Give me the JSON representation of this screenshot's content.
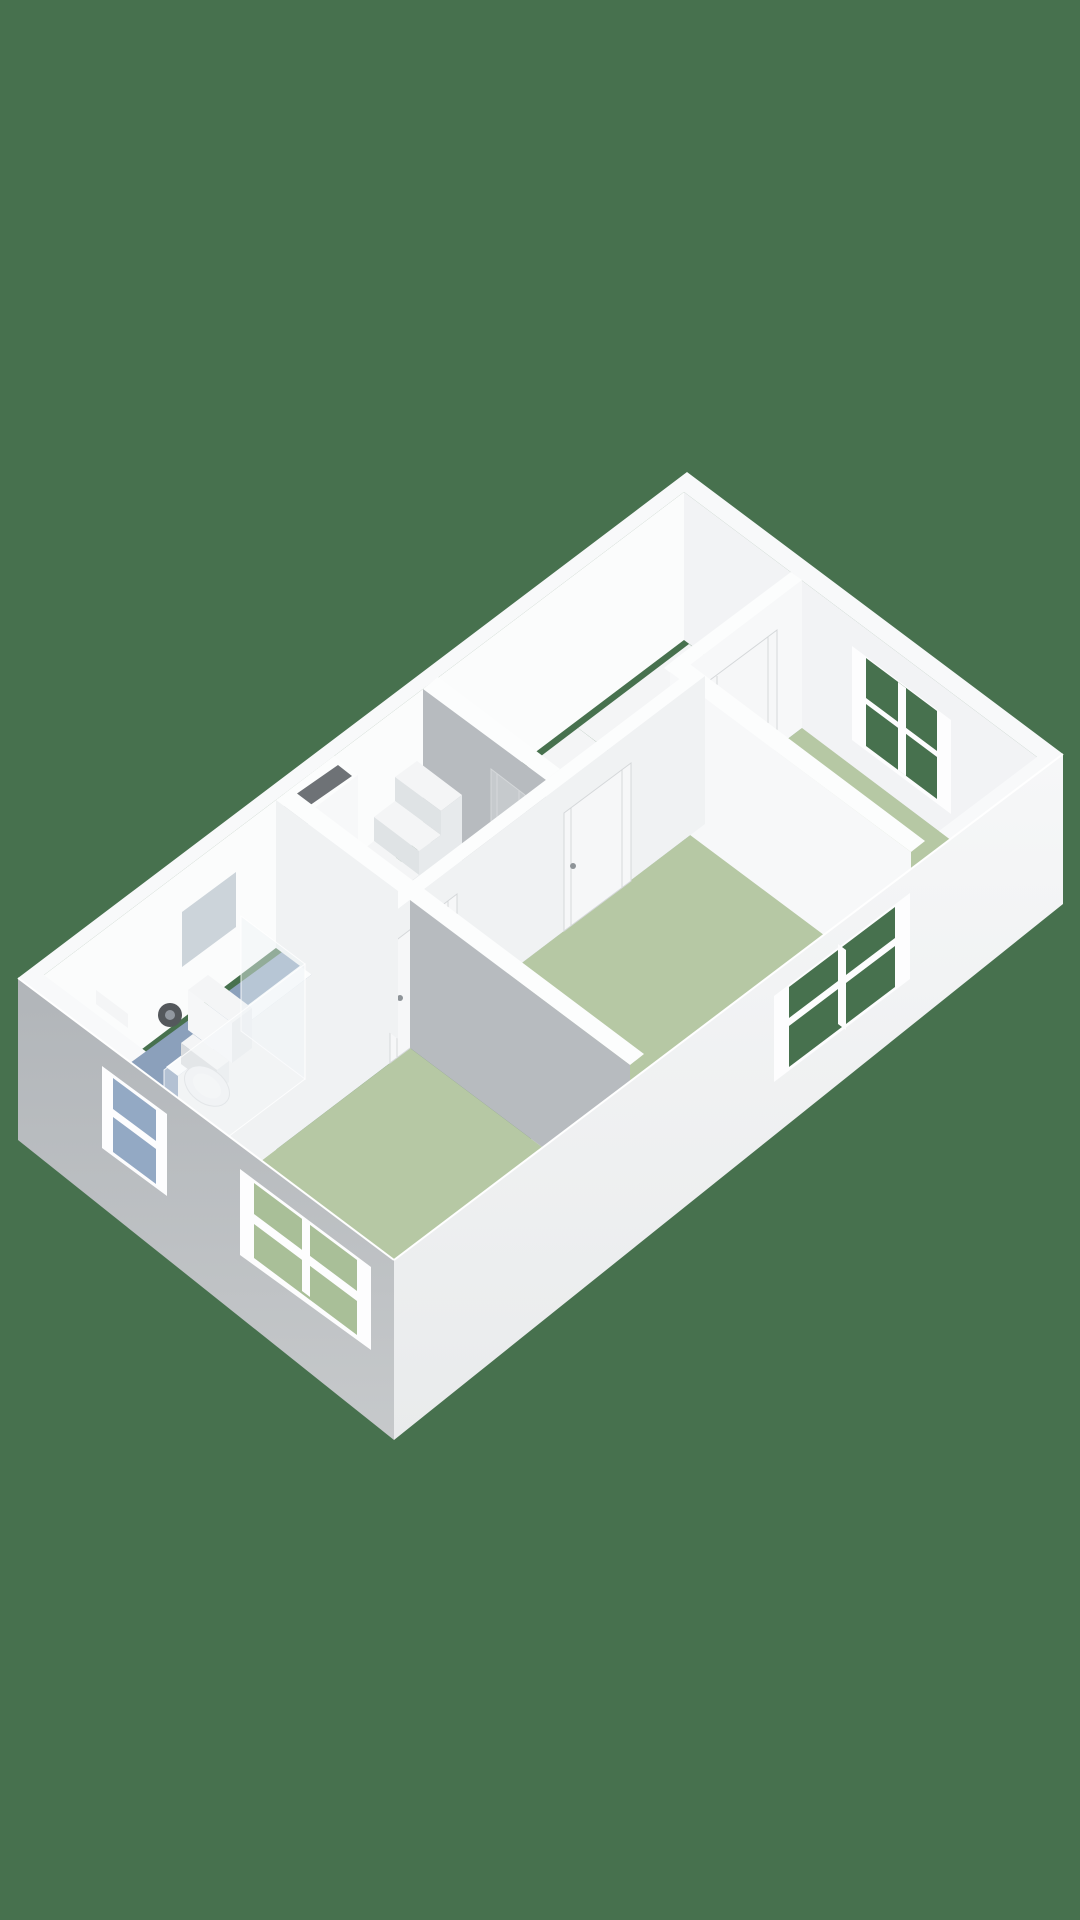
{
  "scene": {
    "kind": "3d-floorplan-render",
    "floor_label": "upper floor",
    "rooms": [
      {
        "name": "landing",
        "floor_color_key": "floor_white"
      },
      {
        "name": "bedroom-1",
        "floor_color_key": "floor_green"
      },
      {
        "name": "bedroom-2",
        "floor_color_key": "floor_green"
      },
      {
        "name": "bedroom-3",
        "floor_color_key": "floor_green"
      },
      {
        "name": "bathroom",
        "floor_color_key": "floor_blue"
      },
      {
        "name": "stairwell",
        "floor_color_key": "background"
      }
    ],
    "windows": [
      {
        "id": "window-bedroom-1",
        "wall": "north-facade"
      },
      {
        "id": "window-bedroom-2",
        "wall": "east-facade"
      },
      {
        "id": "window-bathroom",
        "wall": "south-facade"
      },
      {
        "id": "window-bedroom-3",
        "wall": "south-facade"
      }
    ],
    "doors": [
      "bedroom-1-door",
      "bedroom-2-door",
      "bedroom-3-door",
      "stairwell-door"
    ],
    "fixtures": [
      "staircase",
      "balustrade",
      "duct-shaft",
      "toilet",
      "washbasin-cabinet",
      "mirror",
      "shower-enclosure",
      "shower-mixer",
      "corner-shelf"
    ]
  },
  "palette": {
    "background": "#47714E",
    "rim": "#f8f9fa",
    "face_north": "#f2f3f5",
    "face_west": "#fbfcfc",
    "floor_green": "#b6c8a4",
    "floor_white": "#f4f5f6",
    "floor_blue": "#8ba0bb",
    "wall_top": "#fcfdfd",
    "wall_gray": "#b7bbbf",
    "wall_white": "#f7f8f9",
    "wall_light": "#f0f2f3",
    "shaft_dark": "#6e7276",
    "step_white": "#f4f5f6",
    "step_side": "#e7eaec",
    "riser": "#dfe3e5",
    "ext_east_top": "#f6f7f8",
    "ext_east_bottom": "#e9ebec",
    "ext_south_top": "#b1b5b9",
    "ext_south_bottom": "#c6c9cb",
    "edge_light": "#ffffff",
    "frame": "#fdfdfe",
    "glass_green": "#47714E",
    "glass_green_light": "#a9bf98",
    "glass_blue": "#93a9c4",
    "door_white": "#f6f7f8",
    "door_gray": "#c6cacd",
    "door_line": "#d5d8da",
    "handle": "#8e9498",
    "toilet_white": "#eff1f2",
    "toilet_shade": "#d8dbde",
    "mirror": "#ccd4da",
    "metal_dark": "#54585c",
    "metal_light": "#9298a0",
    "glass_shower": "rgba(238,244,247,0.45)",
    "glass_shower2": "rgba(244,248,250,0.38)",
    "glass_edge": "rgba(255,255,255,0.85)"
  }
}
